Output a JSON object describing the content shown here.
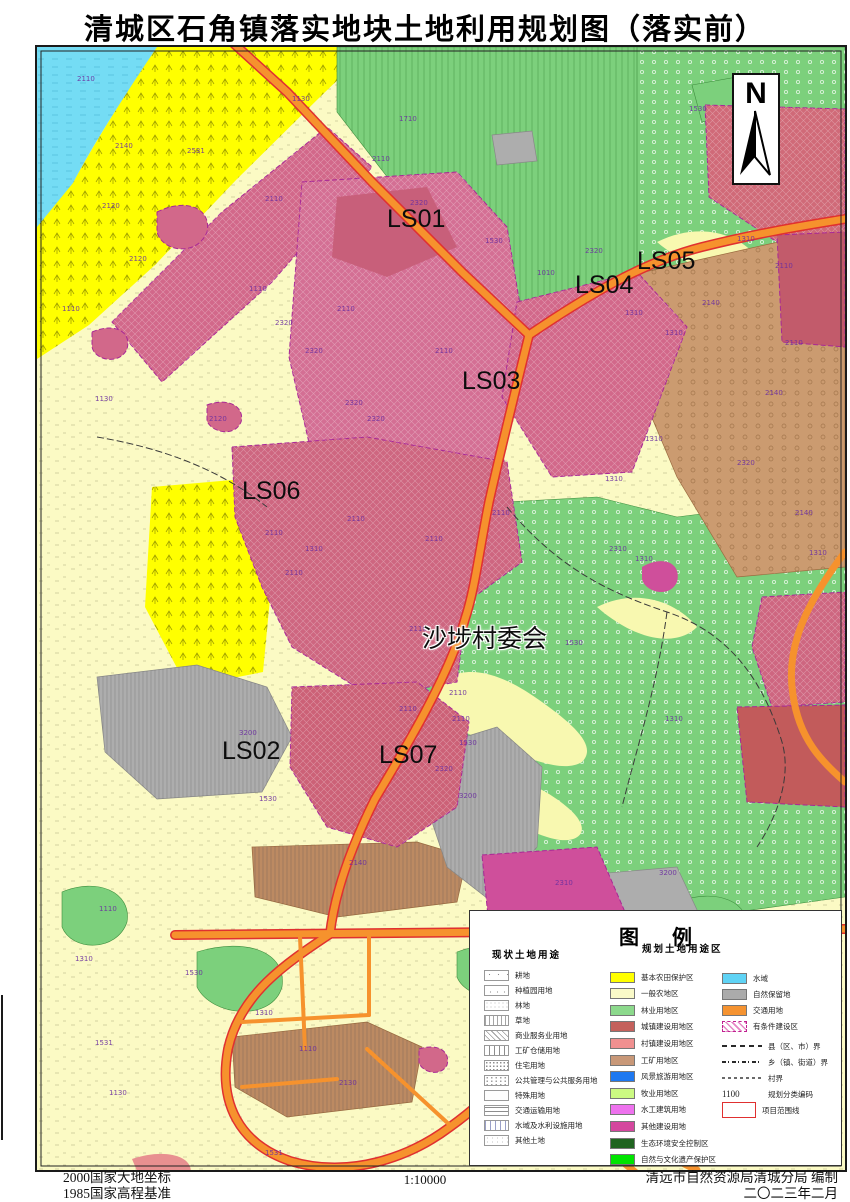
{
  "title": "清城区石角镇落实地块土地利用规划图（落实前）",
  "north": {
    "label": "N"
  },
  "map_labels": [
    {
      "text": "LS01",
      "x": 350,
      "y": 158
    },
    {
      "text": "LS04",
      "x": 538,
      "y": 224
    },
    {
      "text": "LS05",
      "x": 600,
      "y": 200
    },
    {
      "text": "LS03",
      "x": 425,
      "y": 320
    },
    {
      "text": "LS06",
      "x": 205,
      "y": 430
    },
    {
      "text": "沙埗村委会",
      "x": 385,
      "y": 572,
      "halo": true
    },
    {
      "text": "LS02",
      "x": 185,
      "y": 690
    },
    {
      "text": "LS07",
      "x": 342,
      "y": 694
    }
  ],
  "map_codes": [
    {
      "t": "2110",
      "x": 40,
      "y": 28
    },
    {
      "t": "2140",
      "x": 78,
      "y": 95
    },
    {
      "t": "2531",
      "x": 150,
      "y": 100
    },
    {
      "t": "1130",
      "x": 255,
      "y": 48
    },
    {
      "t": "1110",
      "x": 212,
      "y": 238
    },
    {
      "t": "1130",
      "x": 58,
      "y": 348
    },
    {
      "t": "2120",
      "x": 92,
      "y": 208
    },
    {
      "t": "2120",
      "x": 172,
      "y": 368
    },
    {
      "t": "2320",
      "x": 238,
      "y": 272
    },
    {
      "t": "1110",
      "x": 25,
      "y": 258
    },
    {
      "t": "1710",
      "x": 362,
      "y": 68
    },
    {
      "t": "2120",
      "x": 65,
      "y": 155
    },
    {
      "t": "1010",
      "x": 500,
      "y": 222
    },
    {
      "t": "2110",
      "x": 228,
      "y": 148
    },
    {
      "t": "2320",
      "x": 268,
      "y": 300
    },
    {
      "t": "2320",
      "x": 308,
      "y": 352
    },
    {
      "t": "2110",
      "x": 300,
      "y": 258
    },
    {
      "t": "2320",
      "x": 373,
      "y": 152
    },
    {
      "t": "2110",
      "x": 398,
      "y": 300
    },
    {
      "t": "2320",
      "x": 330,
      "y": 368
    },
    {
      "t": "2110",
      "x": 335,
      "y": 108
    },
    {
      "t": "1530",
      "x": 448,
      "y": 190
    },
    {
      "t": "1310",
      "x": 588,
      "y": 262
    },
    {
      "t": "1310",
      "x": 628,
      "y": 282
    },
    {
      "t": "2110",
      "x": 738,
      "y": 215
    },
    {
      "t": "2320",
      "x": 548,
      "y": 200
    },
    {
      "t": "1530",
      "x": 652,
      "y": 58
    },
    {
      "t": "1310",
      "x": 700,
      "y": 188
    },
    {
      "t": "2140",
      "x": 665,
      "y": 252
    },
    {
      "t": "2140",
      "x": 728,
      "y": 342
    },
    {
      "t": "2110",
      "x": 748,
      "y": 292
    },
    {
      "t": "2320",
      "x": 700,
      "y": 412
    },
    {
      "t": "2140",
      "x": 758,
      "y": 462
    },
    {
      "t": "1310",
      "x": 608,
      "y": 388
    },
    {
      "t": "2110",
      "x": 310,
      "y": 468
    },
    {
      "t": "2110",
      "x": 388,
      "y": 488
    },
    {
      "t": "2110",
      "x": 455,
      "y": 462
    },
    {
      "t": "2110",
      "x": 248,
      "y": 522
    },
    {
      "t": "2110",
      "x": 228,
      "y": 482
    },
    {
      "t": "2110",
      "x": 372,
      "y": 578
    },
    {
      "t": "2110",
      "x": 412,
      "y": 642
    },
    {
      "t": "1310",
      "x": 268,
      "y": 498
    },
    {
      "t": "1310",
      "x": 568,
      "y": 428
    },
    {
      "t": "2310",
      "x": 572,
      "y": 498
    },
    {
      "t": "1310",
      "x": 598,
      "y": 508
    },
    {
      "t": "1310",
      "x": 772,
      "y": 502
    },
    {
      "t": "1530",
      "x": 528,
      "y": 592
    },
    {
      "t": "1530",
      "x": 422,
      "y": 692
    },
    {
      "t": "1310",
      "x": 628,
      "y": 668
    },
    {
      "t": "3200",
      "x": 202,
      "y": 682
    },
    {
      "t": "1530",
      "x": 222,
      "y": 748
    },
    {
      "t": "2110",
      "x": 362,
      "y": 658
    },
    {
      "t": "2320",
      "x": 398,
      "y": 718
    },
    {
      "t": "3200",
      "x": 422,
      "y": 745
    },
    {
      "t": "2110",
      "x": 415,
      "y": 668
    },
    {
      "t": "2140",
      "x": 312,
      "y": 812
    },
    {
      "t": "2310",
      "x": 518,
      "y": 832
    },
    {
      "t": "3200",
      "x": 622,
      "y": 822
    },
    {
      "t": "1310",
      "x": 558,
      "y": 872
    },
    {
      "t": "1110",
      "x": 758,
      "y": 868
    },
    {
      "t": "1110",
      "x": 62,
      "y": 858
    },
    {
      "t": "1310",
      "x": 38,
      "y": 908
    },
    {
      "t": "1530",
      "x": 148,
      "y": 922
    },
    {
      "t": "1531",
      "x": 58,
      "y": 992
    },
    {
      "t": "1130",
      "x": 72,
      "y": 1042
    },
    {
      "t": "1310",
      "x": 218,
      "y": 962
    },
    {
      "t": "1110",
      "x": 262,
      "y": 998
    },
    {
      "t": "2120",
      "x": 662,
      "y": 1042
    },
    {
      "t": "1310",
      "x": 648,
      "y": 902
    },
    {
      "t": "2130",
      "x": 302,
      "y": 1032
    },
    {
      "t": "1531",
      "x": 228,
      "y": 1102
    },
    {
      "t": "1310",
      "x": 532,
      "y": 1142
    },
    {
      "t": "1110",
      "x": 728,
      "y": 1088
    },
    {
      "t": "1530",
      "x": 738,
      "y": 1002
    },
    {
      "t": "1030",
      "x": 508,
      "y": 1078
    },
    {
      "t": "1110",
      "x": 598,
      "y": 942
    },
    {
      "t": "1130",
      "x": 692,
      "y": 955
    }
  ],
  "legend": {
    "title": "图  例",
    "current_header": "现状土地用途",
    "planned_header": "规划土地用途区",
    "current_items": [
      {
        "label": "耕地",
        "pattern": "sparse-ticks"
      },
      {
        "label": "种植园用地",
        "pattern": "sparse-ticks2"
      },
      {
        "label": "林地",
        "pattern": "fine-dots"
      },
      {
        "label": "草地",
        "pattern": "dash-columns"
      },
      {
        "label": "商业服务业用地",
        "pattern": "diagonal"
      },
      {
        "label": "工矿仓储用地",
        "pattern": "vertical"
      },
      {
        "label": "住宅用地",
        "pattern": "dense-dots"
      },
      {
        "label": "公共管理与公共服务用地",
        "pattern": "dense-dots2"
      },
      {
        "label": "特殊用地",
        "pattern": "plain"
      },
      {
        "label": "交通运输用地",
        "pattern": "horizontal"
      },
      {
        "label": "水域及水利设施用地",
        "pattern": "tick-columns"
      },
      {
        "label": "其他土地",
        "pattern": "fine-dots2"
      }
    ],
    "planned_items": [
      {
        "label": "基本农田保护区",
        "color": "#FFFF00"
      },
      {
        "label": "一般农地区",
        "color": "#FAFAC8"
      },
      {
        "label": "林业用地区",
        "color": "#8CD98C"
      },
      {
        "label": "城镇建设用地区",
        "color": "#C4615C"
      },
      {
        "label": "村镇建设用地区",
        "color": "#F09090"
      },
      {
        "label": "工矿用地区",
        "color": "#C89878"
      },
      {
        "label": "风景旅游用地区",
        "color": "#1E78F0"
      },
      {
        "label": "牧业用地区",
        "color": "#CCFA82"
      },
      {
        "label": "水工建筑用地",
        "color": "#EE72EE"
      },
      {
        "label": "其他建设用地",
        "color": "#D4479E"
      },
      {
        "label": "生态环境安全控制区",
        "color": "#1F641F"
      },
      {
        "label": "自然与文化遗产保护区",
        "color": "#00E400"
      }
    ],
    "right_items": [
      {
        "label": "水域",
        "type": "swatch",
        "color": "#5FD3F5"
      },
      {
        "label": "自然保留地",
        "type": "swatch",
        "color": "#ABABAB"
      },
      {
        "label": "交通用地",
        "type": "swatch",
        "color": "#F59331"
      },
      {
        "label": "有条件建设区",
        "type": "hatch"
      },
      {
        "label": "县（区、市）界",
        "type": "line",
        "style": "dash-long"
      },
      {
        "label": "乡（镇、街道）界",
        "type": "line",
        "style": "dash-dot"
      },
      {
        "label": "村界",
        "type": "line",
        "style": "dash-fine"
      },
      {
        "label": "规划分类编码",
        "type": "code",
        "sample": "1100"
      },
      {
        "label": "项目范围线",
        "type": "redbox"
      }
    ]
  },
  "footer": {
    "datum_line1": "2000国家大地坐标",
    "datum_line2": "1985国家高程基准",
    "scale": "1:10000",
    "agency": "清远市自然资源局清城分局  编制",
    "date": "二〇二三年二月"
  },
  "colors": {
    "base_farmland": "#FFFF00",
    "general_farm": "#FAFAC4",
    "forest": "#7CD07C",
    "town_build": "#C4615C",
    "village_build": "#D06E88",
    "industry": "#CB9B70",
    "water": "#74DCF4",
    "reserve": "#ADADAD",
    "traffic": "#F6922D",
    "project_line": "#E03030",
    "other_build": "#CF4F9B"
  }
}
